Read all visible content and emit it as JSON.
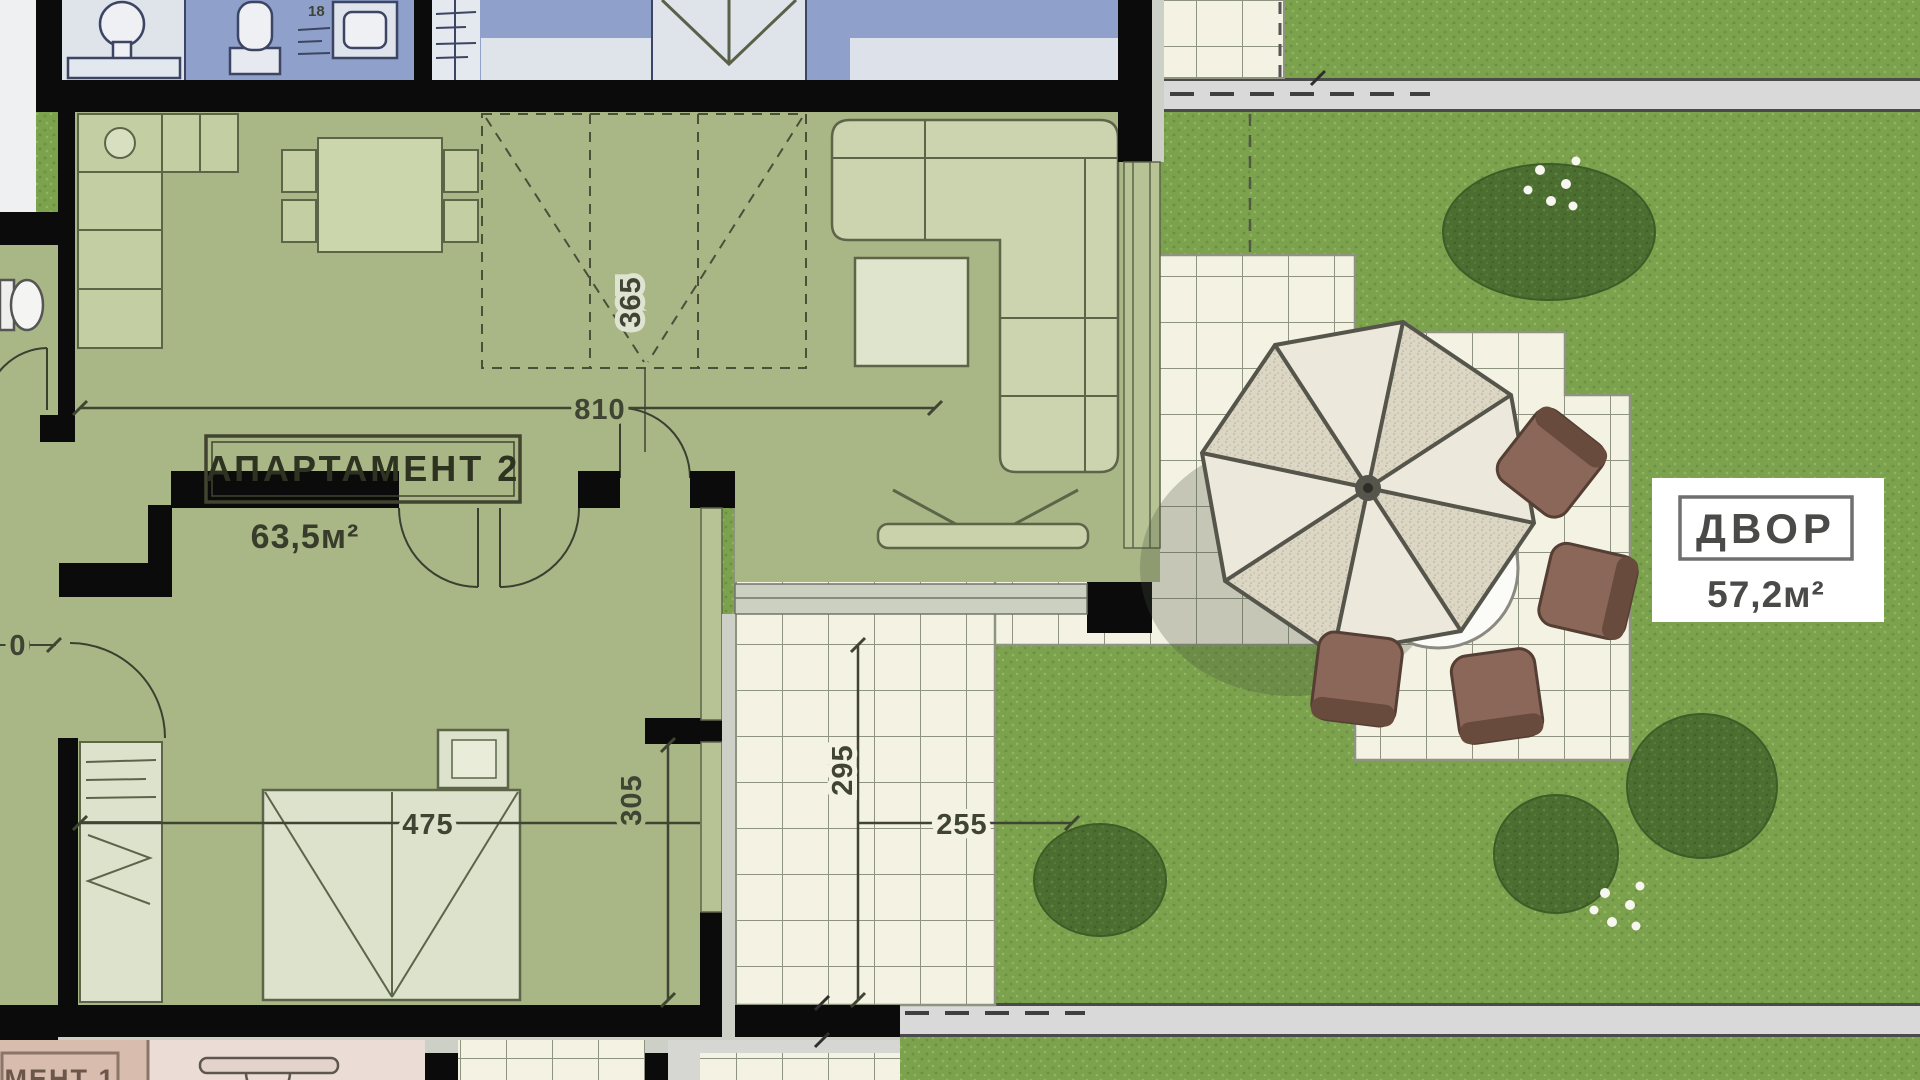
{
  "labels": {
    "apartment2_name": "АПАРТАМЕНТ 2",
    "apartment2_area": "63,5м²",
    "yard_name": "ДВОР",
    "yard_area": "57,2м²",
    "apartment1_partial": "МЕНТ 1"
  },
  "dimensions": {
    "living_width": "810",
    "wardrobe_depth": "365",
    "bedroom_width": "475",
    "bedroom_depth": "305",
    "terrace_depth": "295",
    "terrace_width": "255",
    "edge_partial": "0",
    "top_partial": "18"
  },
  "colors": {
    "room_floor": "#a9b786",
    "furniture_fill": "#c9d3a8",
    "wall": "#0b0b0b",
    "grass": "#7ca24e",
    "bush": "#4c6e31",
    "tile": "#f4f2e3",
    "tile_grid": "#8e9480",
    "path": "#d9d9d9",
    "blue_room": "#8fa0ca",
    "gray_room": "#dfe3ea",
    "umbrella_plain": "#ece8db",
    "umbrella_textured": "#d8d2c0",
    "chair": "#8b6759",
    "pink_room": "#d8bcae",
    "pink_room_light": "#ecdcd6",
    "label_text": "#2e3221",
    "yard_text": "#4a4a48"
  }
}
